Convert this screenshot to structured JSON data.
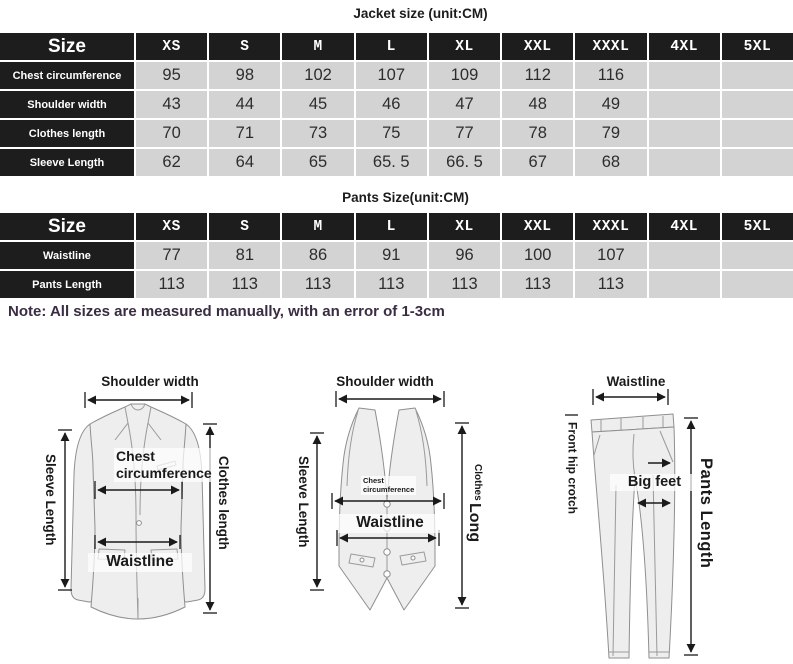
{
  "jacket_table": {
    "title": "Jacket size (unit:CM)",
    "corner": "Size",
    "columns": [
      "XS",
      "S",
      "M",
      "L",
      "XL",
      "XXL",
      "XXXL",
      "4XL",
      "5XL"
    ],
    "rows": [
      {
        "label": "Chest circumference",
        "values": [
          "95",
          "98",
          "102",
          "107",
          "109",
          "112",
          "116",
          "",
          ""
        ]
      },
      {
        "label": "Shoulder width",
        "values": [
          "43",
          "44",
          "45",
          "46",
          "47",
          "48",
          "49",
          "",
          ""
        ]
      },
      {
        "label": "Clothes length",
        "values": [
          "70",
          "71",
          "73",
          "75",
          "77",
          "78",
          "79",
          "",
          ""
        ]
      },
      {
        "label": "Sleeve Length",
        "values": [
          "62",
          "64",
          "65",
          "65. 5",
          "66. 5",
          "67",
          "68",
          "",
          ""
        ]
      }
    ]
  },
  "pants_table": {
    "title": "Pants Size(unit:CM)",
    "corner": "Size",
    "columns": [
      "XS",
      "S",
      "M",
      "L",
      "XL",
      "XXL",
      "XXXL",
      "4XL",
      "5XL"
    ],
    "rows": [
      {
        "label": "Waistline",
        "values": [
          "77",
          "81",
          "86",
          "91",
          "96",
          "100",
          "107",
          "",
          ""
        ]
      },
      {
        "label": "Pants Length",
        "values": [
          "113",
          "113",
          "113",
          "113",
          "113",
          "113",
          "113",
          "",
          ""
        ]
      }
    ]
  },
  "note": "Note: All sizes are measured manually, with an error of 1-3cm",
  "diagrams": {
    "jacket": {
      "shoulder_width": "Shoulder width",
      "sleeve_length": "Sleeve Length",
      "chest_line1": "Chest",
      "chest_line2": "circumference",
      "waistline": "Waistline",
      "clothes_length": "Clothes length"
    },
    "vest": {
      "shoulder_width": "Shoulder width",
      "sleeve_length": "Sleeve Length",
      "chest_line1": "Chest",
      "chest_line2": "circumference",
      "waistline": "Waistline",
      "clothes_word": "Clothes",
      "long_word": "Long"
    },
    "pants": {
      "waistline": "Waistline",
      "front_hip_crotch": "Front hip crotch",
      "big_feet": "Big feet",
      "pants_length": "Pants Length"
    }
  },
  "colors": {
    "table_header_bg": "#1d1d1d",
    "table_header_text": "#ffffff",
    "table_cell_bg": "#d3d3d3",
    "note_text": "#3a2c42",
    "arrow": "#1a1a1a",
    "garment_fill": "#eeeeee",
    "garment_stroke": "#8f8f8f"
  }
}
